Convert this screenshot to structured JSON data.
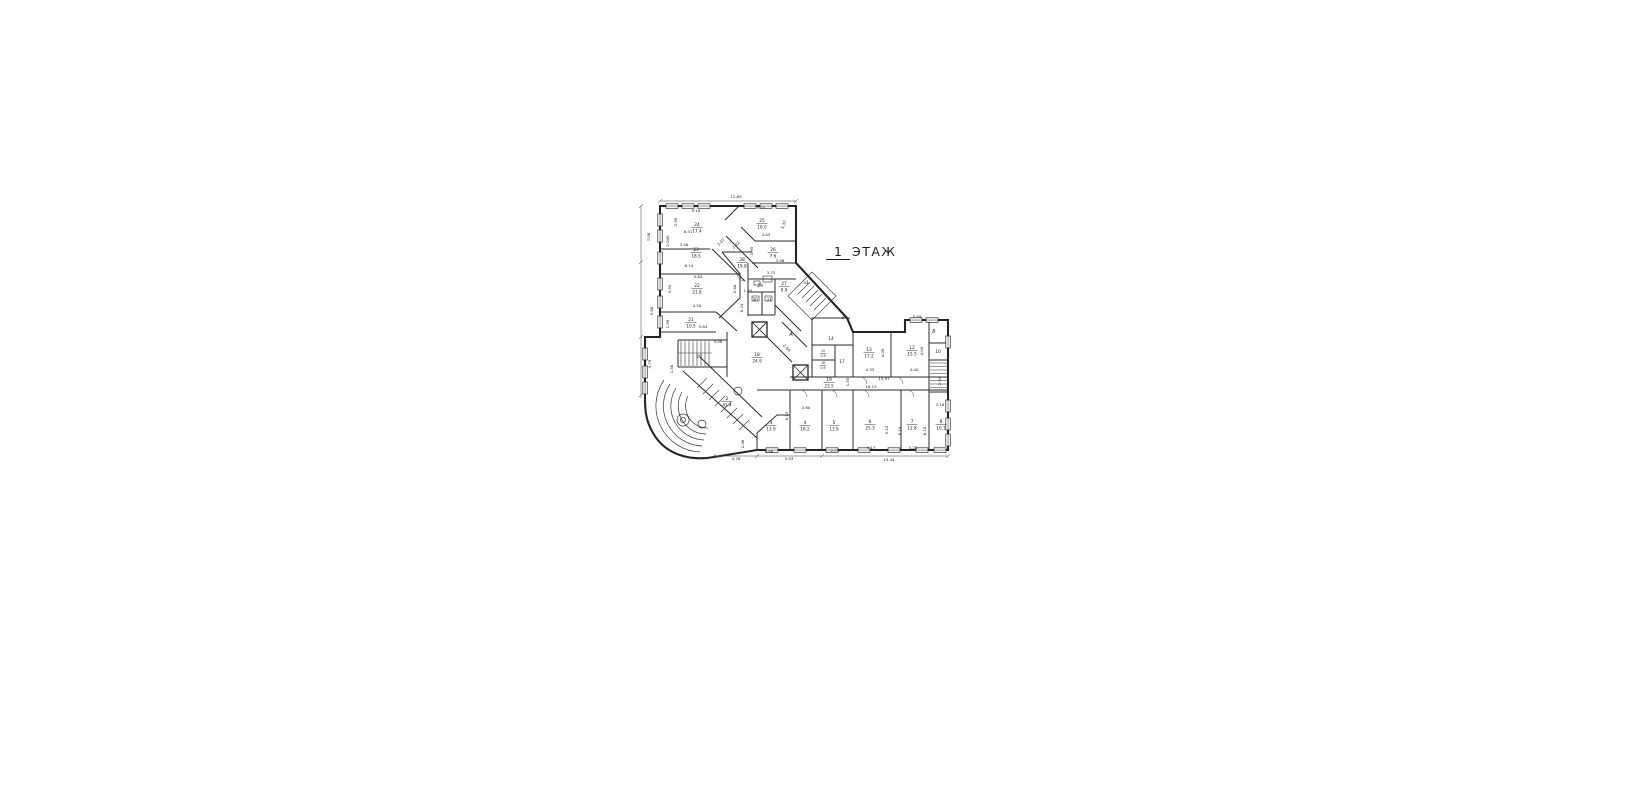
{
  "title": {
    "number": "1",
    "word": "ЭТАЖ"
  },
  "plan": {
    "rooms": [
      {
        "number": "24",
        "area": "17.4",
        "x": 697,
        "y": 226
      },
      {
        "number": "23",
        "area": "18.5",
        "x": 696,
        "y": 251
      },
      {
        "number": "22",
        "area": "21.8",
        "x": 697,
        "y": 287
      },
      {
        "number": "21",
        "area": "10.5",
        "x": 691,
        "y": 321
      },
      {
        "number": "25",
        "area": "18.0",
        "x": 762,
        "y": 222
      },
      {
        "number": "26",
        "area": "7.6",
        "x": 773,
        "y": 251
      },
      {
        "number": "28",
        "area": "19.8",
        "x": 742,
        "y": 261
      },
      {
        "number": "27",
        "area": "8.9",
        "x": 784,
        "y": 285
      },
      {
        "number": "18",
        "area": "24.9",
        "x": 757,
        "y": 356
      },
      {
        "number": "19",
        "area": "23.5",
        "x": 829,
        "y": 381
      },
      {
        "number": "13",
        "area": "17.2",
        "x": 869,
        "y": 351
      },
      {
        "number": "12",
        "area": "15.5",
        "x": 912,
        "y": 349
      },
      {
        "number": "15",
        "area": "0.9",
        "x": 823,
        "y": 352,
        "small": true
      },
      {
        "number": "16",
        "area": "0.9",
        "x": 823,
        "y": 364,
        "small": true
      },
      {
        "number": "2",
        "area": "41.4",
        "x": 727,
        "y": 400
      },
      {
        "number": "3",
        "area": "13.9",
        "x": 771,
        "y": 424
      },
      {
        "number": "4",
        "area": "16.2",
        "x": 805,
        "y": 424
      },
      {
        "number": "5",
        "area": "13.9",
        "x": 834,
        "y": 424
      },
      {
        "number": "6",
        "area": "25.3",
        "x": 870,
        "y": 423
      },
      {
        "number": "7",
        "area": "12.8",
        "x": 912,
        "y": 423
      },
      {
        "number": "8",
        "area": "10.1",
        "x": 941,
        "y": 423
      }
    ],
    "labels": [
      {
        "text": "20",
        "x": 699,
        "y": 358
      },
      {
        "text": "14",
        "x": 831,
        "y": 340
      },
      {
        "text": "17",
        "x": 842,
        "y": 363
      },
      {
        "text": "29",
        "x": 760,
        "y": 287
      },
      {
        "text": "30",
        "x": 755,
        "y": 301
      },
      {
        "text": "31",
        "x": 769,
        "y": 301
      },
      {
        "text": "10",
        "x": 938,
        "y": 353
      },
      {
        "text": "А",
        "x": 791,
        "y": 336,
        "italic": true,
        "size": 5.5
      },
      {
        "text": "а1",
        "x": 806,
        "y": 284,
        "italic": true,
        "size": 4.5
      },
      {
        "text": "а",
        "x": 843,
        "y": 319,
        "italic": true,
        "size": 4.5
      },
      {
        "text": "Б",
        "x": 934,
        "y": 333,
        "italic": true,
        "size": 5
      }
    ],
    "dims": [
      {
        "t": "12.69",
        "x": 736,
        "y": 198
      },
      {
        "t": "9.10",
        "x": 696,
        "y": 212
      },
      {
        "t": "2.95",
        "x": 677,
        "y": 222,
        "r": -90
      },
      {
        "t": "8.51",
        "x": 688,
        "y": 233
      },
      {
        "t": "3.46",
        "x": 684,
        "y": 246
      },
      {
        "t": "2.945",
        "x": 669,
        "y": 241,
        "r": -90
      },
      {
        "t": "7.08",
        "x": 650,
        "y": 237,
        "r": -90
      },
      {
        "t": "6.14",
        "x": 689,
        "y": 267
      },
      {
        "t": "9.74",
        "x": 761,
        "y": 209
      },
      {
        "t": "5.37",
        "x": 785,
        "y": 225,
        "r": -72
      },
      {
        "t": "4.05",
        "x": 766,
        "y": 236
      },
      {
        "t": "2.47",
        "x": 722,
        "y": 243,
        "r": -45
      },
      {
        "t": "2.42",
        "x": 737,
        "y": 246,
        "r": -45
      },
      {
        "t": "1.95",
        "x": 753,
        "y": 251,
        "r": -90
      },
      {
        "t": "3.98",
        "x": 780,
        "y": 262
      },
      {
        "t": "3.73",
        "x": 771,
        "y": 274
      },
      {
        "t": "5.84",
        "x": 698,
        "y": 278
      },
      {
        "t": "5.92",
        "x": 671,
        "y": 289,
        "r": -90
      },
      {
        "t": "2.48",
        "x": 736,
        "y": 289,
        "r": -90
      },
      {
        "t": "4.50",
        "x": 697,
        "y": 307
      },
      {
        "t": "1.55",
        "x": 748,
        "y": 292
      },
      {
        "t": "6.74",
        "x": 743,
        "y": 308,
        "r": -90
      },
      {
        "t": "5.88",
        "x": 653,
        "y": 311,
        "r": -90
      },
      {
        "t": "1.99",
        "x": 669,
        "y": 324,
        "r": -90
      },
      {
        "t": "5.84",
        "x": 703,
        "y": 328
      },
      {
        "t": "5.08",
        "x": 718,
        "y": 343
      },
      {
        "t": "4.79",
        "x": 651,
        "y": 364,
        "r": -90
      },
      {
        "t": "1.46",
        "x": 673,
        "y": 369,
        "r": -90
      },
      {
        "t": "2.68",
        "x": 786,
        "y": 349,
        "r": 45
      },
      {
        "t": "4.35",
        "x": 870,
        "y": 371
      },
      {
        "t": "4.05",
        "x": 884,
        "y": 353,
        "r": -90
      },
      {
        "t": "4.00",
        "x": 914,
        "y": 371
      },
      {
        "t": "4.04",
        "x": 923,
        "y": 351,
        "r": -90
      },
      {
        "t": "13.97",
        "x": 884,
        "y": 380
      },
      {
        "t": "16.13",
        "x": 871,
        "y": 388
      },
      {
        "t": "1.55",
        "x": 849,
        "y": 382,
        "r": -90
      },
      {
        "t": "5.99",
        "x": 917,
        "y": 318
      },
      {
        "t": "2.54",
        "x": 941,
        "y": 381,
        "r": -90
      },
      {
        "t": "3.16",
        "x": 940,
        "y": 406
      },
      {
        "t": "2.80",
        "x": 806,
        "y": 409
      },
      {
        "t": "6.23",
        "x": 788,
        "y": 416,
        "r": -90
      },
      {
        "t": "2.06",
        "x": 744,
        "y": 444,
        "r": -90
      },
      {
        "t": "5.98",
        "x": 769,
        "y": 453
      },
      {
        "t": "2.71",
        "x": 835,
        "y": 452
      },
      {
        "t": "4.17",
        "x": 871,
        "y": 449
      },
      {
        "t": "5.12",
        "x": 888,
        "y": 430,
        "r": -90
      },
      {
        "t": "3.28",
        "x": 913,
        "y": 449
      },
      {
        "t": "6.10",
        "x": 901,
        "y": 431,
        "r": -90
      },
      {
        "t": "6.10",
        "x": 926,
        "y": 431,
        "r": -90
      },
      {
        "t": "4.76",
        "x": 736,
        "y": 460
      },
      {
        "t": "5.93",
        "x": 789,
        "y": 460
      },
      {
        "t": "13.44",
        "x": 889,
        "y": 461
      }
    ]
  }
}
